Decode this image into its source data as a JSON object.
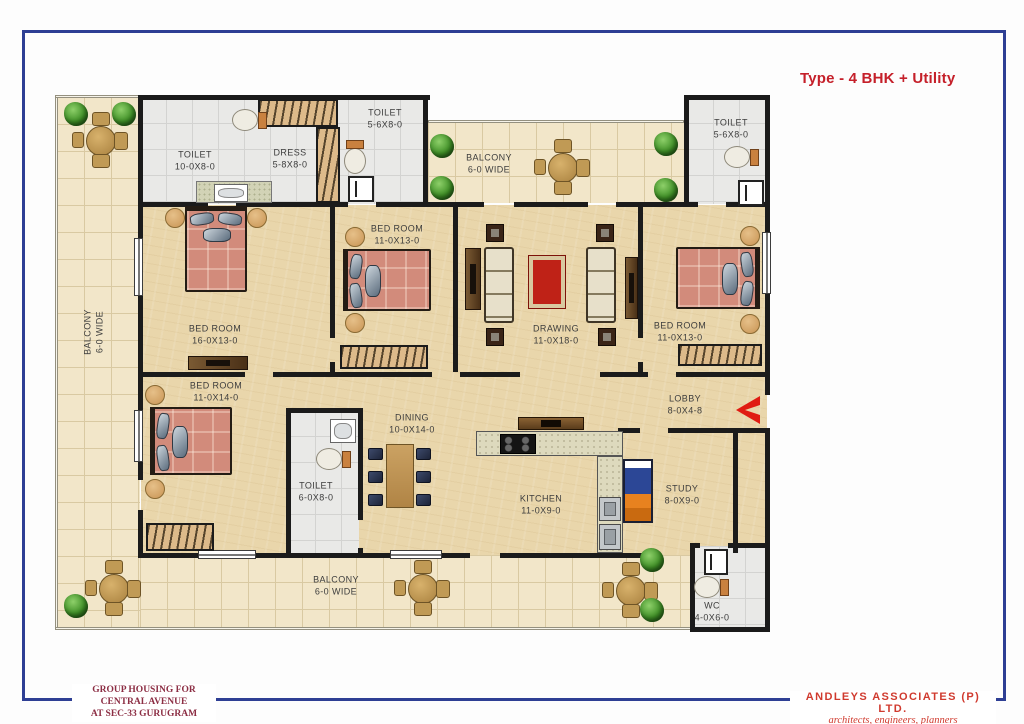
{
  "title": "Type - 4 BHK + Utility",
  "rooms": {
    "balcony_left": {
      "name": "BALCONY",
      "dims": "6-0 WIDE"
    },
    "toilet_master": {
      "name": "TOILET",
      "dims": "10-0X8-0"
    },
    "dress": {
      "name": "DRESS",
      "dims": "5-8X8-0"
    },
    "toilet_mid_top": {
      "name": "TOILET",
      "dims": "5-6X8-0"
    },
    "balcony_top": {
      "name": "BALCONY",
      "dims": "6-0 WIDE"
    },
    "toilet_top_right": {
      "name": "TOILET",
      "dims": "5-6X8-0"
    },
    "bedroom_master": {
      "name": "BED ROOM",
      "dims": "16-0X13-0"
    },
    "bedroom_mid": {
      "name": "BED ROOM",
      "dims": "11-0X13-0"
    },
    "drawing": {
      "name": "DRAWING",
      "dims": "11-0X18-0"
    },
    "bedroom_right": {
      "name": "BED ROOM",
      "dims": "11-0X13-0"
    },
    "bedroom_lower": {
      "name": "BED ROOM",
      "dims": "11-0X14-0"
    },
    "toilet_lower": {
      "name": "TOILET",
      "dims": "6-0X8-0"
    },
    "dining": {
      "name": "DINING",
      "dims": "10-0X14-0"
    },
    "lobby": {
      "name": "LOBBY",
      "dims": "8-0X4-8"
    },
    "kitchen": {
      "name": "KITCHEN",
      "dims": "11-0X9-0"
    },
    "study": {
      "name": "STUDY",
      "dims": "8-0X9-0"
    },
    "balcony_bottom": {
      "name": "BALCONY",
      "dims": "6-0 WIDE"
    },
    "wc": {
      "name": "WC",
      "dims": "4-0X6-0"
    }
  },
  "footer": {
    "project_line1": "GROUP HOUSING FOR",
    "project_line2": "CENTRAL AVENUE",
    "project_line3": "AT SEC-33 GURUGRAM",
    "firm_name": "ANDLEYS ASSOCIATES (P) LTD.",
    "firm_tagline": "architects, engineers, planners"
  },
  "colors": {
    "frame_blue": "#2e3f94",
    "title_red": "#c5202a",
    "project_maroon": "#8c2e44",
    "firm_red": "#d03a2e",
    "entry_arrow_red": "#e01b12"
  }
}
